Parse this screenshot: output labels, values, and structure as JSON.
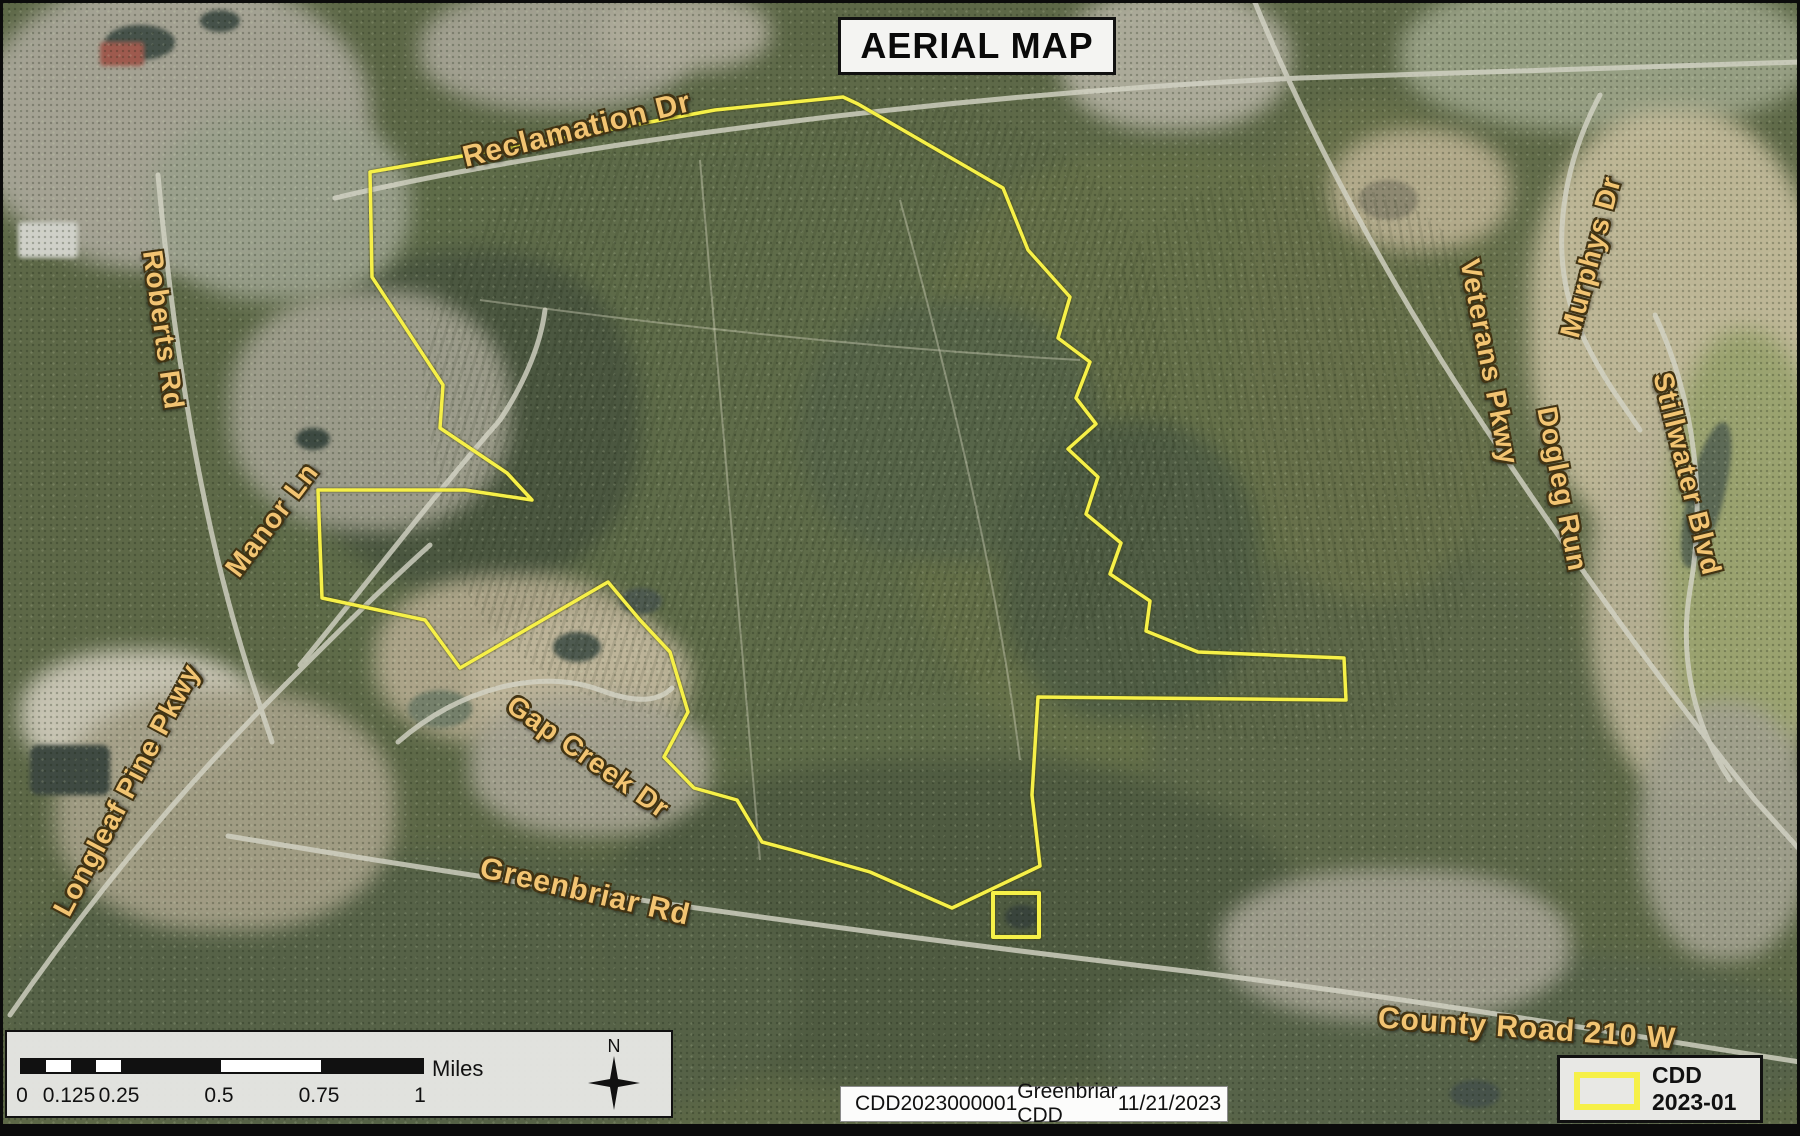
{
  "title": "AERIAL MAP",
  "roads": {
    "labels": [
      {
        "text": "Reclamation Dr"
      },
      {
        "text": "Roberts Rd"
      },
      {
        "text": "Manor Ln"
      },
      {
        "text": "Longleaf Pine Pkwy"
      },
      {
        "text": "Gap Creek Dr"
      },
      {
        "text": "Greenbriar Rd"
      },
      {
        "text": "County Road 210 W"
      },
      {
        "text": "Veterans Pkwy"
      },
      {
        "text": "Murphys Dr"
      },
      {
        "text": "Dogleg Run"
      },
      {
        "text": "Stillwater Blvd"
      }
    ]
  },
  "scale_bar": {
    "tick_labels": [
      "0",
      "0.125",
      "0.25",
      "0.5",
      "0.75",
      "1"
    ],
    "unit": "Miles"
  },
  "compass": {
    "north_label": "N"
  },
  "info_bar": {
    "items": [
      "CDD",
      "2023000001",
      "Greenbriar CDD",
      "11/21/2023"
    ]
  },
  "legend": {
    "item_label": "CDD 2023-01"
  },
  "colors": {
    "boundary_yellow": "#F6F048",
    "road_label_orange": "#F2C472"
  }
}
